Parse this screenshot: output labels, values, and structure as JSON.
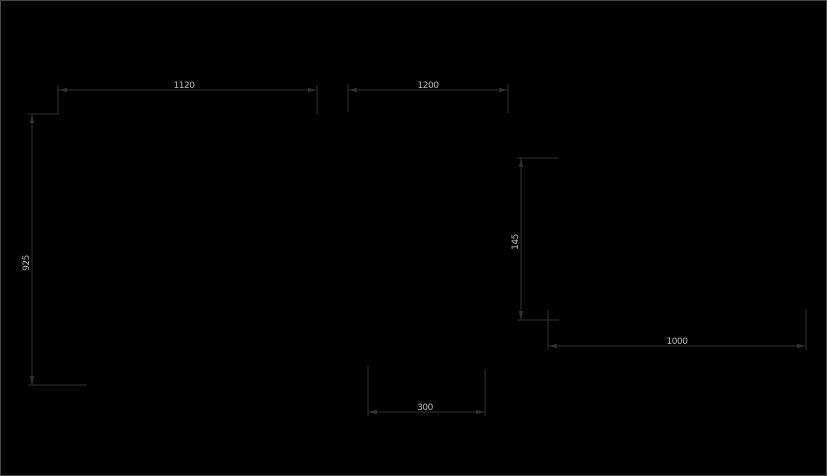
{
  "canvas": {
    "width": 827,
    "height": 476,
    "background_color": "#000000",
    "border_color": "#4a4a4a",
    "line_color": "#303030",
    "text_color": "#b9b9b9"
  },
  "drawing": {
    "type": "cad-dimension-drawing",
    "dimensions": [
      {
        "name": "dim-top-left-width",
        "label": "1120",
        "orientation": "horizontal",
        "line": {
          "x1": 57,
          "y1": 89,
          "x2": 316,
          "y2": 89
        },
        "extensions": [
          {
            "x1": 57,
            "y1": 84,
            "x2": 57,
            "y2": 113
          },
          {
            "x1": 316,
            "y1": 84,
            "x2": 316,
            "y2": 113
          }
        ],
        "label_pos": {
          "x": 183,
          "y": 87
        },
        "label_rotated": false
      },
      {
        "name": "dim-top-right-width",
        "label": "1200",
        "orientation": "horizontal",
        "line": {
          "x1": 347,
          "y1": 89,
          "x2": 507,
          "y2": 89
        },
        "extensions": [
          {
            "x1": 347,
            "y1": 83,
            "x2": 347,
            "y2": 111
          },
          {
            "x1": 507,
            "y1": 83,
            "x2": 507,
            "y2": 112
          }
        ],
        "label_pos": {
          "x": 427,
          "y": 87
        },
        "label_rotated": false
      },
      {
        "name": "dim-left-height",
        "label": "925",
        "orientation": "vertical",
        "line": {
          "x1": 31,
          "y1": 113,
          "x2": 31,
          "y2": 384
        },
        "extensions": [
          {
            "x1": 27,
            "y1": 113,
            "x2": 57,
            "y2": 113
          },
          {
            "x1": 27,
            "y1": 384,
            "x2": 86,
            "y2": 384
          }
        ],
        "label_pos": {
          "x": 28,
          "y": 262
        },
        "label_rotated": true
      },
      {
        "name": "dim-right-height",
        "label": "145",
        "orientation": "vertical",
        "line": {
          "x1": 520,
          "y1": 157,
          "x2": 520,
          "y2": 319
        },
        "extensions": [
          {
            "x1": 516,
            "y1": 157,
            "x2": 558,
            "y2": 157
          },
          {
            "x1": 516,
            "y1": 319,
            "x2": 558,
            "y2": 319
          }
        ],
        "label_pos": {
          "x": 517,
          "y": 241
        },
        "label_rotated": true
      },
      {
        "name": "dim-bottom-right-width",
        "label": "1000",
        "orientation": "horizontal",
        "line": {
          "x1": 547,
          "y1": 345,
          "x2": 805,
          "y2": 345
        },
        "extensions": [
          {
            "x1": 547,
            "y1": 308,
            "x2": 547,
            "y2": 349
          },
          {
            "x1": 805,
            "y1": 308,
            "x2": 805,
            "y2": 349
          }
        ],
        "label_pos": {
          "x": 676,
          "y": 343
        },
        "label_rotated": false
      },
      {
        "name": "dim-bottom-center-width",
        "label": "300",
        "orientation": "horizontal",
        "line": {
          "x1": 367,
          "y1": 411,
          "x2": 484,
          "y2": 411
        },
        "extensions": [
          {
            "x1": 367,
            "y1": 365,
            "x2": 367,
            "y2": 415
          },
          {
            "x1": 484,
            "y1": 368,
            "x2": 484,
            "y2": 415
          }
        ],
        "label_pos": {
          "x": 424,
          "y": 409
        },
        "label_rotated": false
      }
    ]
  }
}
